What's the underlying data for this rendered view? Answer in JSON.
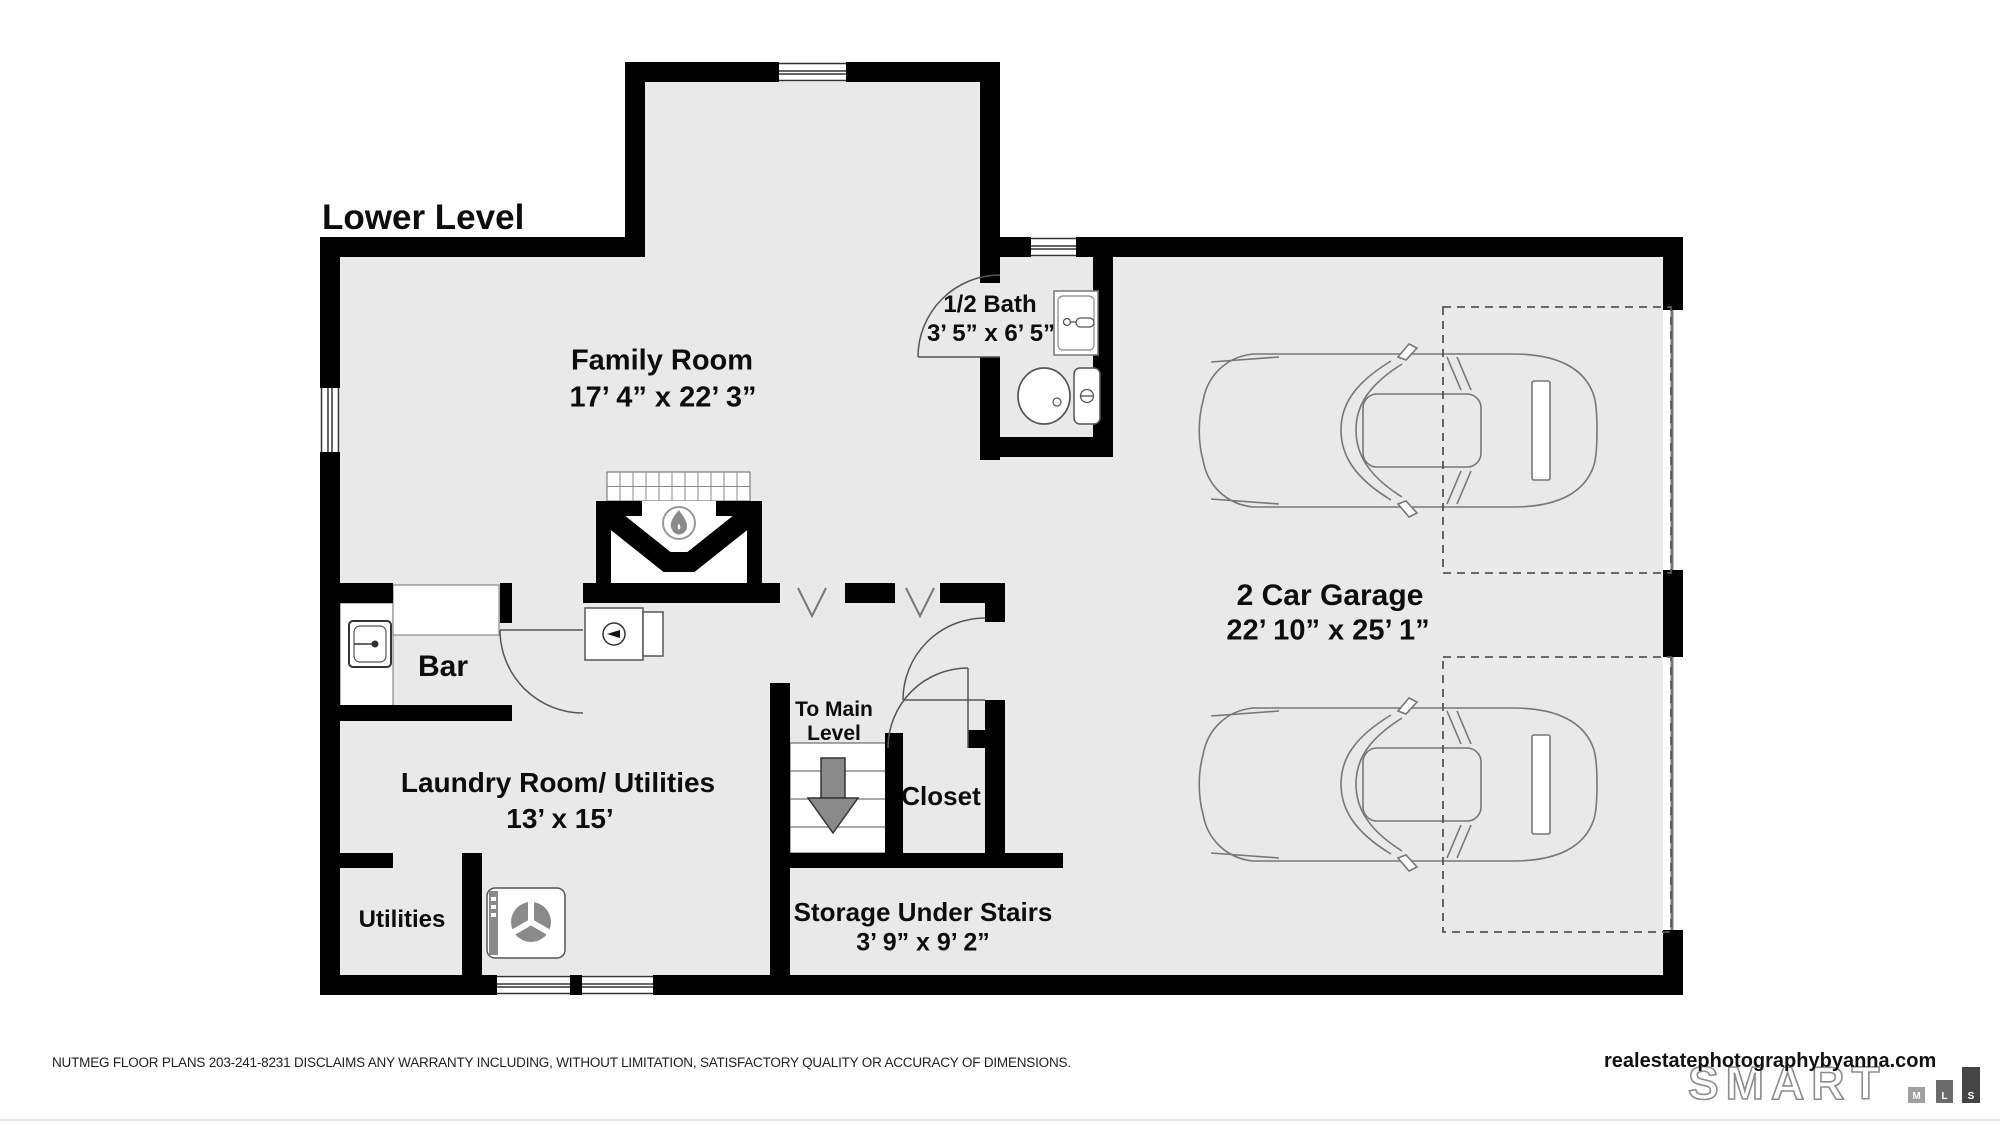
{
  "title": "Lower Level",
  "rooms": {
    "family_room": {
      "name": "Family Room",
      "dims": "17’ 4” x 22’ 3”"
    },
    "half_bath": {
      "name": "1/2 Bath",
      "dims": "3’ 5” x 6’ 5”"
    },
    "garage": {
      "name": "2 Car Garage",
      "dims": "22’ 10” x 25’ 1”"
    },
    "bar": {
      "name": "Bar"
    },
    "laundry": {
      "name": "Laundry Room/ Utilities",
      "dims": "13’ x 15’"
    },
    "utilities": {
      "name": "Utilities"
    },
    "stairs": {
      "name": "To Main Level"
    },
    "closet": {
      "name": "Closet"
    },
    "storage": {
      "name": "Storage Under Stairs",
      "dims": "3’ 9” x 9’ 2”"
    }
  },
  "footer": {
    "disclaimer": "NUTMEG FLOOR PLANS 203-241-8231 DISCLAIMS ANY WARRANTY INCLUDING, WITHOUT LIMITATION, SATISFACTORY QUALITY OR ACCURACY OF DIMENSIONS.",
    "website": "realestatephotographybyanna.com",
    "logo": {
      "brand": "SMART",
      "m": "M",
      "l": "L",
      "s": "S"
    }
  },
  "colors": {
    "floor": "#e9e9e9",
    "wall": "#000000",
    "line": "#777777",
    "arrow": "#8a8a8a"
  }
}
